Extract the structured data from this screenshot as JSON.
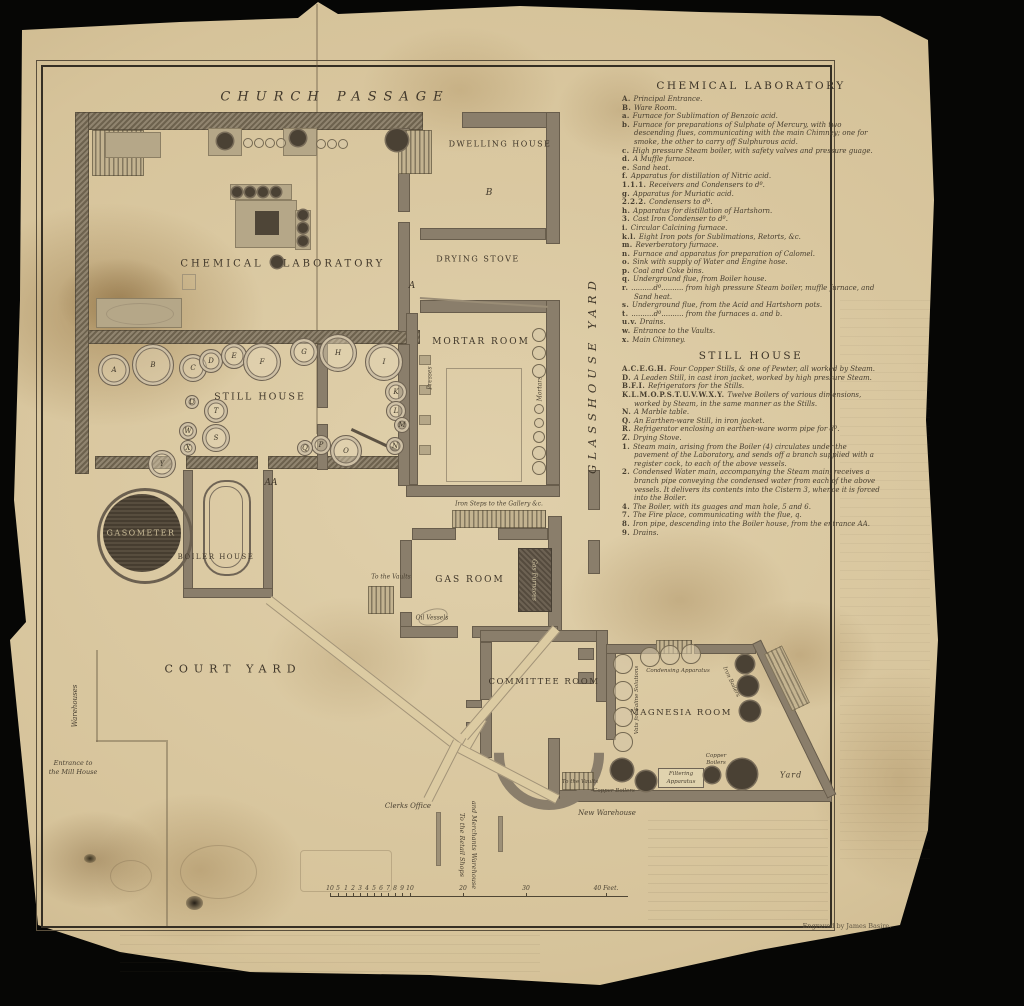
{
  "plan": {
    "street_label": "CHURCH  PASSAGE",
    "glasshouse_yard": "GLASSHOUSE  YARD",
    "rooms": {
      "dwelling_house": "DWELLING HOUSE",
      "room_b": "B",
      "drying_stove": "DRYING STOVE",
      "room_a": "A",
      "chemical_word": "CHEMICAL",
      "laboratory_word": "LABORATORY",
      "mortar_room": "MORTAR ROOM",
      "still_house": "STILL HOUSE",
      "gas_room": "GAS ROOM",
      "committee_room": "COMMITTEE ROOM",
      "magnesia_room": "MAGNESIA ROOM",
      "boiler_house": "BOILER HOUSE",
      "gasometer": "GASOMETER",
      "court_yard": "COURT  YARD",
      "entrance_aa": "AA",
      "yard": "Yard"
    },
    "annotations": {
      "iron_steps": "Iron Steps to the Gallery &c.",
      "to_the_vaults": "To the Vaults",
      "to_the_vaults_2": "To the Vaults",
      "oil_vessels": "Oil Vessels",
      "gas_furnaces": "Gas Furnaces",
      "presses": "Presses",
      "mortars": "Mortars",
      "warehouses": "Warehouses",
      "entrance_mill_1": "Entrance to",
      "entrance_mill_2": "the Mill House",
      "clerks_office": "Clerks Office",
      "retail_1": "To the Retail Shops",
      "retail_2": "and Merchants Warehouse",
      "new_warehouse": "New Warehouse",
      "condensing": "Condensing Apparatus",
      "vats": "Vats for Saline Solutions",
      "iron_boilers": "Iron Boilers",
      "copper_boilers_1": "Copper Boilers",
      "copper_boilers_2a": "Copper",
      "copper_boilers_2b": "Boilers",
      "filtering_1": "Filtering",
      "filtering_2": "Apparatus"
    },
    "stills": [
      {
        "label": "A",
        "x": 113,
        "y": 369,
        "r": 15
      },
      {
        "label": "B",
        "x": 152,
        "y": 364,
        "r": 20
      },
      {
        "label": "C",
        "x": 192,
        "y": 367,
        "r": 13
      },
      {
        "label": "D",
        "x": 210,
        "y": 360,
        "r": 11
      },
      {
        "label": "E",
        "x": 233,
        "y": 355,
        "r": 12
      },
      {
        "label": "F",
        "x": 261,
        "y": 361,
        "r": 18
      },
      {
        "label": "G",
        "x": 303,
        "y": 351,
        "r": 13
      },
      {
        "label": "H",
        "x": 337,
        "y": 352,
        "r": 18
      },
      {
        "label": "I",
        "x": 383,
        "y": 361,
        "r": 18
      },
      {
        "label": "K",
        "x": 395,
        "y": 391,
        "r": 10
      },
      {
        "label": "L",
        "x": 395,
        "y": 410,
        "r": 9
      },
      {
        "label": "M",
        "x": 401,
        "y": 424,
        "r": 7
      },
      {
        "label": "N",
        "x": 394,
        "y": 445,
        "r": 8
      },
      {
        "label": "O",
        "x": 345,
        "y": 450,
        "r": 15
      },
      {
        "label": "P",
        "x": 320,
        "y": 444,
        "r": 9
      },
      {
        "label": "Q",
        "x": 304,
        "y": 447,
        "r": 7
      },
      {
        "label": "S",
        "x": 215,
        "y": 437,
        "r": 13
      },
      {
        "label": "T",
        "x": 215,
        "y": 410,
        "r": 11
      },
      {
        "label": "U",
        "x": 191,
        "y": 401,
        "r": 6
      },
      {
        "label": "W",
        "x": 187,
        "y": 430,
        "r": 8
      },
      {
        "label": "X",
        "x": 187,
        "y": 447,
        "r": 7
      },
      {
        "label": "Y",
        "x": 161,
        "y": 463,
        "r": 13
      }
    ],
    "circles": [
      {
        "t": "dark",
        "x": 225,
        "y": 141,
        "r": 8
      },
      {
        "t": "dark",
        "x": 298,
        "y": 138,
        "r": 8
      },
      {
        "t": "dark",
        "x": 397,
        "y": 140,
        "r": 11
      },
      {
        "t": "dark",
        "x": 237,
        "y": 192,
        "r": 5
      },
      {
        "t": "dark",
        "x": 250,
        "y": 192,
        "r": 5
      },
      {
        "t": "dark",
        "x": 263,
        "y": 192,
        "r": 5
      },
      {
        "t": "dark",
        "x": 276,
        "y": 192,
        "r": 5
      },
      {
        "t": "dark",
        "x": 303,
        "y": 215,
        "r": 5
      },
      {
        "t": "dark",
        "x": 303,
        "y": 228,
        "r": 5
      },
      {
        "t": "dark",
        "x": 303,
        "y": 241,
        "r": 5
      },
      {
        "t": "dark",
        "x": 277,
        "y": 262,
        "r": 6
      },
      {
        "t": "dark",
        "x": 745,
        "y": 664,
        "r": 9
      },
      {
        "t": "dark",
        "x": 748,
        "y": 686,
        "r": 10
      },
      {
        "t": "dark",
        "x": 750,
        "y": 711,
        "r": 10
      },
      {
        "t": "dark",
        "x": 622,
        "y": 770,
        "r": 11
      },
      {
        "t": "dark",
        "x": 646,
        "y": 781,
        "r": 10
      },
      {
        "t": "dark",
        "x": 712,
        "y": 775,
        "r": 8
      },
      {
        "t": "dark",
        "x": 742,
        "y": 774,
        "r": 15
      },
      {
        "t": "open",
        "x": 247,
        "y": 142,
        "r": 4
      },
      {
        "t": "open",
        "x": 258,
        "y": 142,
        "r": 4
      },
      {
        "t": "open",
        "x": 269,
        "y": 142,
        "r": 4
      },
      {
        "t": "open",
        "x": 280,
        "y": 142,
        "r": 4
      },
      {
        "t": "open",
        "x": 320,
        "y": 143,
        "r": 4
      },
      {
        "t": "open",
        "x": 331,
        "y": 143,
        "r": 4
      },
      {
        "t": "open",
        "x": 342,
        "y": 143,
        "r": 4
      },
      {
        "t": "open",
        "x": 649,
        "y": 656,
        "r": 9
      },
      {
        "t": "open",
        "x": 669,
        "y": 654,
        "r": 9
      },
      {
        "t": "open",
        "x": 690,
        "y": 653,
        "r": 9
      },
      {
        "t": "open",
        "x": 622,
        "y": 663,
        "r": 9
      },
      {
        "t": "open",
        "x": 622,
        "y": 690,
        "r": 9
      },
      {
        "t": "open",
        "x": 622,
        "y": 716,
        "r": 9
      },
      {
        "t": "open",
        "x": 622,
        "y": 741,
        "r": 9
      },
      {
        "t": "open",
        "x": 538,
        "y": 334,
        "r": 6
      },
      {
        "t": "open",
        "x": 538,
        "y": 352,
        "r": 6
      },
      {
        "t": "open",
        "x": 538,
        "y": 370,
        "r": 6
      },
      {
        "t": "open",
        "x": 538,
        "y": 408,
        "r": 4
      },
      {
        "t": "open",
        "x": 538,
        "y": 422,
        "r": 4
      },
      {
        "t": "open",
        "x": 538,
        "y": 436,
        "r": 5
      },
      {
        "t": "open",
        "x": 538,
        "y": 452,
        "r": 6
      },
      {
        "t": "open",
        "x": 538,
        "y": 467,
        "r": 6
      }
    ]
  },
  "legend": {
    "chemical": {
      "title": "CHEMICAL LABORATORY",
      "items": [
        {
          "k": "A.",
          "t": "Principal Entrance."
        },
        {
          "k": "B.",
          "t": "Ware Room."
        },
        {
          "k": "a.",
          "t": "Furnace for Sublimation of Benzoic acid."
        },
        {
          "k": "b.",
          "t": "Furnace for preparations of Sulphate of Mercury, with two descending flues, communicating with the main Chimney; one for smoke, the other to carry off Sulphurous acid."
        },
        {
          "k": "c.",
          "t": "High pressure Steam boiler, with safety valves and pressure guage."
        },
        {
          "k": "d.",
          "t": "A Muffle furnace."
        },
        {
          "k": "e.",
          "t": "Sand heat."
        },
        {
          "k": "f.",
          "t": "Apparatus for distillation of Nitric acid."
        },
        {
          "k": "1.1.1.",
          "t": "Receivers and Condensers to      dº."
        },
        {
          "k": "g.",
          "t": "Apparatus for Muriatic acid."
        },
        {
          "k": "2.2.2.",
          "t": "Condensers to      dº."
        },
        {
          "k": "h.",
          "t": "Apparatus for distillation of Hartshorn."
        },
        {
          "k": "3.",
          "t": "Cast Iron Condenser to      dº."
        },
        {
          "k": "i.",
          "t": "Circular Calcining furnace."
        },
        {
          "k": "k.l.",
          "t": "Eight Iron pots for Sublimations, Retorts, &c."
        },
        {
          "k": "m.",
          "t": "Reverberatory furnace."
        },
        {
          "k": "n.",
          "t": "Furnace and apparatus for preparation of Calomel."
        },
        {
          "k": "o.",
          "t": "Sink with supply of Water and Engine hose."
        },
        {
          "k": "p.",
          "t": "Coal and Coke bins."
        },
        {
          "k": "q.",
          "t": "Underground flue, from Boiler house."
        },
        {
          "k": "r.",
          "t": "..........dº.......... from high pressure Steam boiler, muffle furnace, and Sand heat."
        },
        {
          "k": "s.",
          "t": "Underground flue, from the Acid and Hartshorn pots."
        },
        {
          "k": "t.",
          "t": "..........dº.......... from the furnaces a. and b."
        },
        {
          "k": "u.v.",
          "t": "Drains."
        },
        {
          "k": "w.",
          "t": "Entrance to the Vaults."
        },
        {
          "k": "x.",
          "t": "Main Chimney."
        }
      ]
    },
    "still_house": {
      "title": "STILL HOUSE",
      "items": [
        {
          "k": "A.C.E.G.H.",
          "t": "Four Copper Stills, & one of Pewter, all worked by Steam."
        },
        {
          "k": "D.",
          "t": "A Leaden Still, in cast iron jacket, worked by high pressure Steam."
        },
        {
          "k": "B.F.I.",
          "t": "Refrigerators for the Stills."
        },
        {
          "k": "K.L.M.O.P.S.T.U.V.W.X.Y.",
          "t": "Twelve Boilers of various dimensions, worked by Steam, in the same manner as the Stills."
        },
        {
          "k": "N.",
          "t": "A Marble table."
        },
        {
          "k": "Q.",
          "t": "An Earthen-ware Still, in iron jacket."
        },
        {
          "k": "R.",
          "t": "Refrigerator enclosing an earthen-ware worm pipe for dº."
        },
        {
          "k": "Z.",
          "t": "Drying Stove."
        },
        {
          "k": "1.",
          "t": "Steam main, arising from the Boiler (4) circulates under the pavement of the Laboratory, and sends off a branch supplied with a register cock, to each of the above vessels."
        },
        {
          "k": "2.",
          "t": "Condensed Water main, accompanying the Steam main, receives a branch pipe conveying the condensed water from each of the above vessels. It delivers its contents into the Cistern 3, whence it is forced into the Boiler."
        },
        {
          "k": "4.",
          "t": "The Boiler, with its guages and man hole, 5 and 6."
        },
        {
          "k": "7.",
          "t": "The Fire place, communicating with the flue, q."
        },
        {
          "k": "8.",
          "t": "Iron pipe, descending into the Boiler house, from the entrance AA."
        },
        {
          "k": "9.",
          "t": "Drains."
        }
      ]
    }
  },
  "scale": {
    "ticks": [
      {
        "label": "10",
        "x": 330
      },
      {
        "label": "5",
        "x": 338
      },
      {
        "label": "1",
        "x": 346
      },
      {
        "label": "2",
        "x": 353
      },
      {
        "label": "3",
        "x": 360
      },
      {
        "label": "4",
        "x": 367
      },
      {
        "label": "5",
        "x": 374
      },
      {
        "label": "6",
        "x": 381
      },
      {
        "label": "7",
        "x": 388
      },
      {
        "label": "8",
        "x": 395
      },
      {
        "label": "9",
        "x": 402
      },
      {
        "label": "10",
        "x": 410
      },
      {
        "label": "20",
        "x": 463
      },
      {
        "label": "30",
        "x": 526
      },
      {
        "label": "40 Feet.",
        "x": 606
      }
    ]
  },
  "credit": "Engraved by James Basire."
}
